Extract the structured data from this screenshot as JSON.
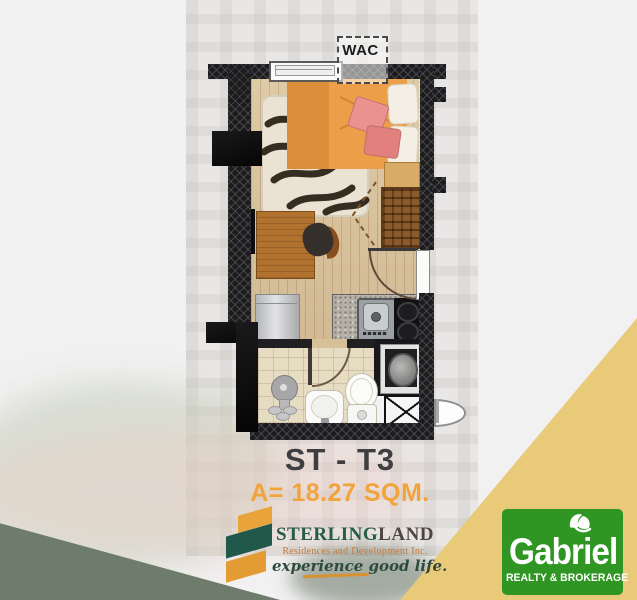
{
  "plan": {
    "wac_label": "WAC",
    "unit_code": "ST - T3",
    "area": "A= 18.27 SQM."
  },
  "sterling": {
    "name_primary": "STERLING",
    "name_secondary": "LAND",
    "subtitle": "Residences and Development Inc.",
    "tagline": "experience good life."
  },
  "gabriel": {
    "name": "Gabriel",
    "subtitle": "REALTY & BROKERAGE"
  },
  "icons": {
    "sterling_mark": "sterling-ribbon-s-icon",
    "gabriel_mark": "leaf-icon"
  },
  "colors": {
    "accent_orange": "#F2A43C",
    "sterling_green": "#265C49",
    "gabriel_green": "#2F9523",
    "band_yellow": "#E9CA79",
    "wedge_sage": "#6E7D6B",
    "unit_text": "#3E3E40"
  }
}
